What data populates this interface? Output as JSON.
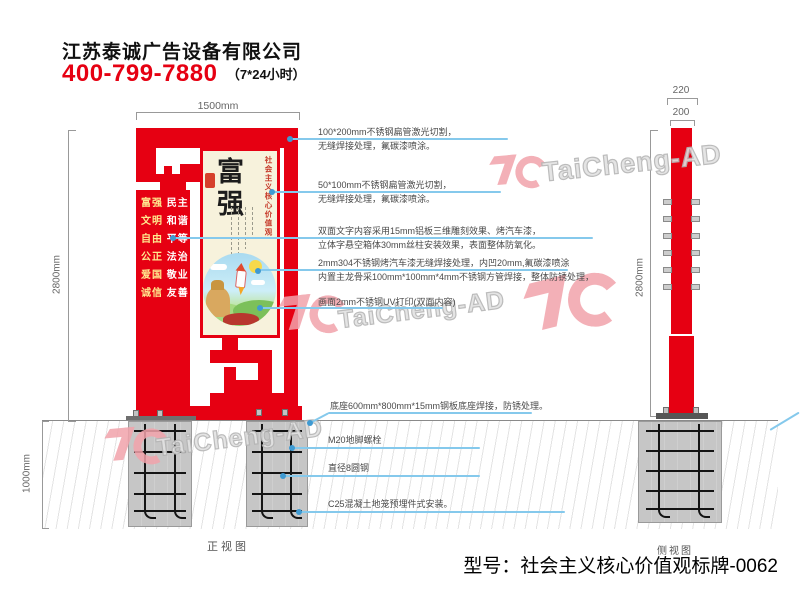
{
  "header": {
    "company": "江苏泰诚广告设备有限公司",
    "phone": "400-799-7880",
    "hours": "（7*24小时）"
  },
  "front": {
    "label": "正视图",
    "dim_width": "1500mm",
    "dim_height": "2800mm",
    "dim_underground": "1000mm",
    "values": [
      {
        "a": "富强",
        "b": "民主"
      },
      {
        "a": "文明",
        "b": "和谐"
      },
      {
        "a": "自由",
        "b": "平等"
      },
      {
        "a": "公正",
        "b": "法治"
      },
      {
        "a": "爱国",
        "b": "敬业"
      },
      {
        "a": "诚信",
        "b": "友善"
      }
    ],
    "poster": {
      "title": "富强",
      "side_text": "社会主义核心价值观"
    }
  },
  "side": {
    "label": "侧视图",
    "dim_outer": "220",
    "dim_inner": "200",
    "dim_height": "2800mm"
  },
  "annotations": [
    {
      "line1": "100*200mm不锈钢扁管激光切割，",
      "line2": "无缝焊接处理，氟碳漆喷涂。"
    },
    {
      "line1": "50*100mm不锈钢扁管激光切割，",
      "line2": "无缝焊接处理，氟碳漆喷涂。"
    },
    {
      "line1": "双面文字内容采用15mm铝板三维雕刻效果、烤汽车漆，",
      "line2": "立体字悬空箱体30mm丝柱安装效果，表面整体防氧化。"
    },
    {
      "line1": "2mm304不锈钢烤汽车漆无缝焊接处理，内凹20mm,氟碳漆喷涂",
      "line2": "内置主龙骨采100mm*100mm*4mm不锈钢方管焊接，整体防锈处理，"
    },
    {
      "line1": "画面2mm不锈钢UV打印(双面内容)",
      "line2": ""
    },
    {
      "line1": "底座600mm*800mm*15mm钢板底座焊接，防锈处理。",
      "line2": ""
    },
    {
      "line1": "M20地脚螺栓",
      "line2": ""
    },
    {
      "line1": "直径8圆钢",
      "line2": ""
    },
    {
      "line1": "C25混凝土地笼预埋件式安装。",
      "line2": ""
    }
  ],
  "footer": {
    "model": "型号：社会主义核心价值观标牌-0062"
  },
  "watermark": {
    "text": "TaiCheng-AD"
  },
  "colors": {
    "red": "#e60012",
    "leader_blue": "#85c9ec",
    "watermark_pink": "#f2a3ab"
  }
}
